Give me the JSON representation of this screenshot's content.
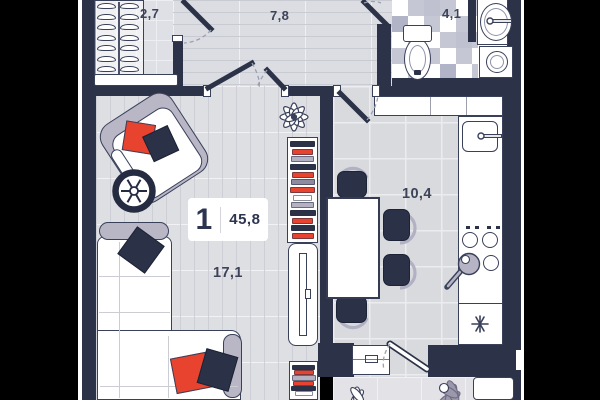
{
  "scene": {
    "bg_outside": "#000000",
    "type": "apartment-floor-plan"
  },
  "unit": {
    "rooms_count": "1",
    "area": "45,8"
  },
  "rooms": [
    {
      "id": "wardrobe",
      "label": "2,7"
    },
    {
      "id": "hallway",
      "label": "7,8"
    },
    {
      "id": "bathroom",
      "label": "4,1"
    },
    {
      "id": "kitchen",
      "label": "10,4"
    },
    {
      "id": "living-room",
      "label": "17,1"
    }
  ],
  "palette": {
    "wall": "#2c3349",
    "floor": "#dcdde2",
    "accent_red": "#e8432f",
    "navy_furniture": "#2b3147",
    "gray_furniture": "#b9b6c6",
    "tile_dark": "#c6c7d5",
    "outline": "#39405a"
  },
  "wardrobe": {
    "hanger_count": 7
  },
  "bookshelves": {
    "top_rows": [
      {
        "color": "#2b3147",
        "w": 23
      },
      {
        "color": "#e8432f",
        "w": 19
      },
      {
        "color": "#b4b2c2",
        "w": 21
      },
      {
        "color": "#2b3147",
        "w": 24
      },
      {
        "color": "#e8432f",
        "w": 20
      },
      {
        "color": "#8e8ba1",
        "w": 22
      },
      {
        "color": "#e8432f",
        "w": 23
      },
      {
        "color": "#ffffff",
        "w": 17
      },
      {
        "color": "#b4b2c2",
        "w": 21
      },
      {
        "color": "#2b3147",
        "w": 24
      },
      {
        "color": "#e8432f",
        "w": 19
      },
      {
        "color": "#2b3147",
        "w": 22
      },
      {
        "color": "#e8432f",
        "w": 20
      }
    ],
    "bottom_rows": [
      {
        "color": "#2b3147",
        "w": 21
      },
      {
        "color": "#e8432f",
        "w": 18
      },
      {
        "color": "#b4b2c2",
        "w": 22
      },
      {
        "color": "#e8432f",
        "w": 19
      },
      {
        "color": "#2b3147",
        "w": 23
      },
      {
        "color": "#ffffff",
        "w": 16
      }
    ]
  }
}
